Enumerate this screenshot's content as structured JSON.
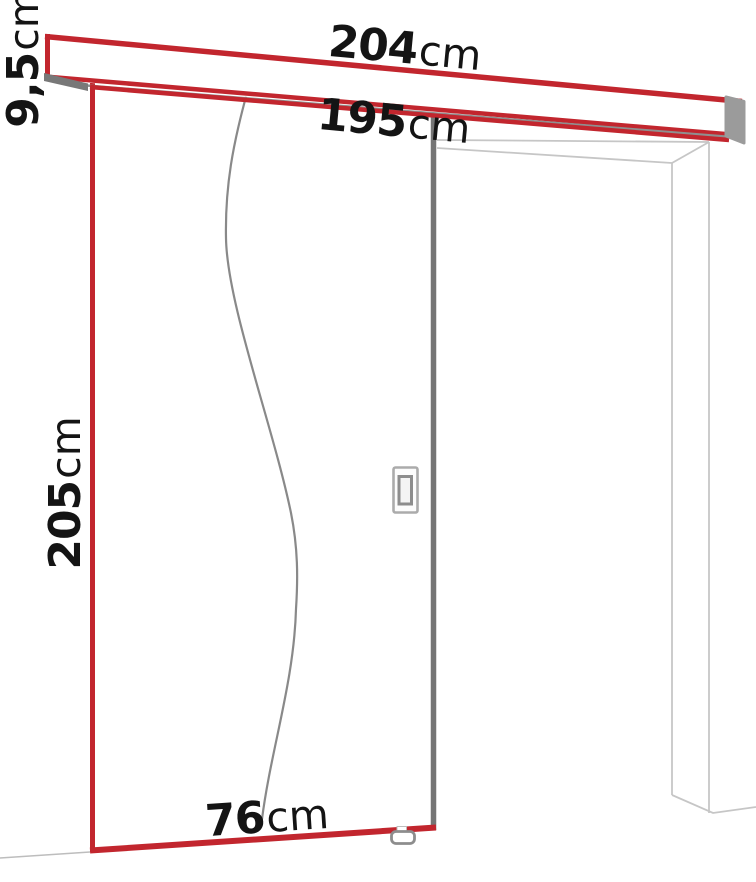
{
  "figure": {
    "name": "sliding-door-dimension-diagram"
  },
  "labels": {
    "rail_length": {
      "value": "204",
      "unit": "cm"
    },
    "track_length": {
      "value": "195",
      "unit": "cm"
    },
    "rail_height": {
      "value": "9,5",
      "unit": "cm"
    },
    "door_height": {
      "value": "205",
      "unit": "cm"
    },
    "door_width": {
      "value": "76",
      "unit": "cm"
    }
  },
  "colors": {
    "accent_red": "#c2262e",
    "door_edge_gray": "#757575",
    "track_gray": "#8f8f8f",
    "frame_gray": "#c6c6c6",
    "label_text": "#141414"
  }
}
